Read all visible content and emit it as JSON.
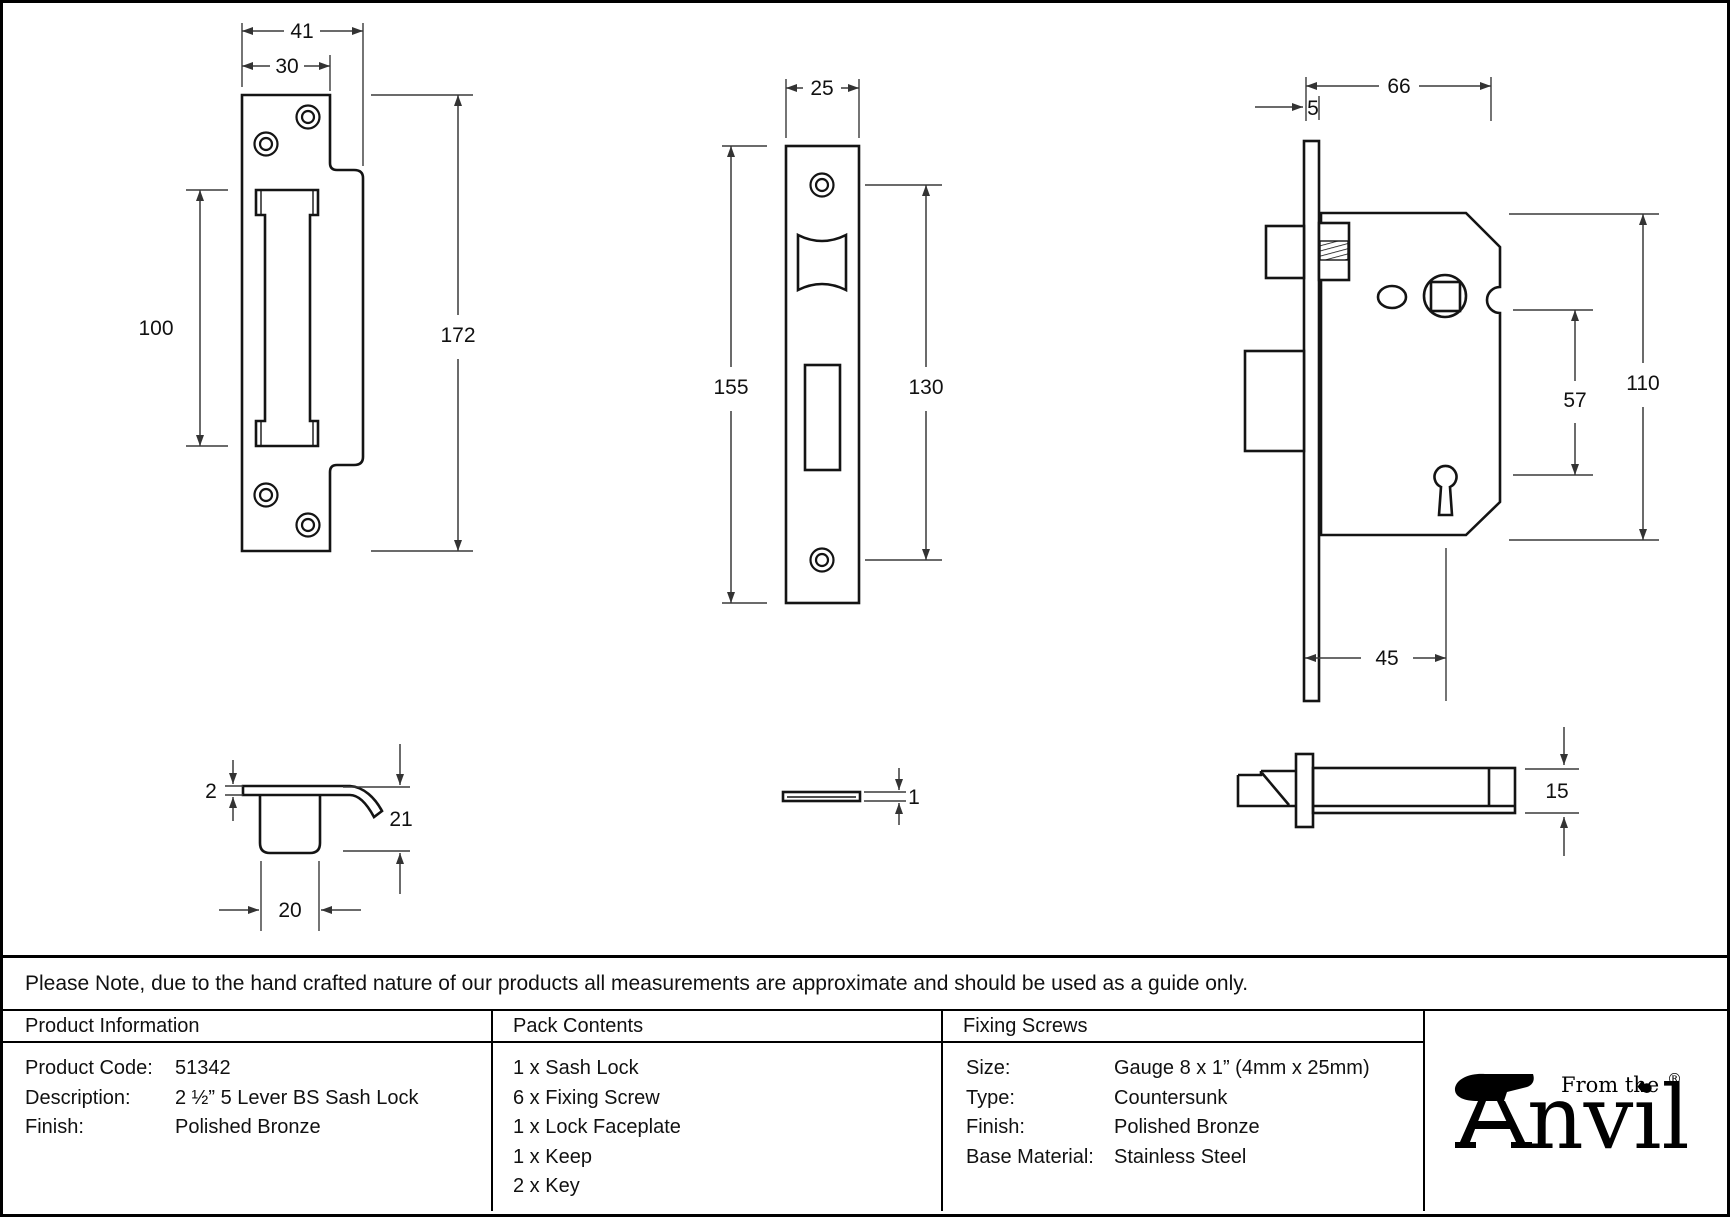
{
  "note": "Please Note, due to the hand crafted nature of our products all measurements are approximate and should be used as a guide only.",
  "drawings": {
    "keep_front": {
      "overall_width": "41",
      "plate_width": "30",
      "opening_height": "100",
      "total_height": "172"
    },
    "faceplate_front": {
      "width": "25",
      "total_height": "155",
      "screw_centres": "130"
    },
    "lock_side": {
      "case_depth": "66",
      "faceplate_thickness": "5",
      "case_height": "110",
      "spindle_to_keyhole": "57",
      "backset": "45"
    },
    "keep_profile": {
      "plate_thickness": "2",
      "depth": "21",
      "box_width": "20"
    },
    "faceplate_profile": {
      "thickness": "1"
    },
    "lock_profile": {
      "case_thickness": "15"
    }
  },
  "table": {
    "product_information": {
      "header": "Product Information",
      "rows": [
        {
          "label": "Product Code:",
          "value": "51342"
        },
        {
          "label": "Description:",
          "value": "2 ½” 5 Lever BS Sash Lock"
        },
        {
          "label": "Finish:",
          "value": "Polished Bronze"
        }
      ]
    },
    "pack_contents": {
      "header": "Pack Contents",
      "items": [
        "1 x Sash Lock",
        "6 x Fixing Screw",
        "1 x Lock Faceplate",
        "1 x Keep",
        "2 x Key"
      ]
    },
    "fixing_screws": {
      "header": "Fixing Screws",
      "rows": [
        {
          "label": "Size:",
          "value": "Gauge 8 x 1” (4mm x 25mm)"
        },
        {
          "label": "Type:",
          "value": "Countersunk"
        },
        {
          "label": "Finish:",
          "value": "Polished Bronze"
        },
        {
          "label": "Base Material:",
          "value": "Stainless Steel"
        }
      ]
    }
  },
  "logo": {
    "tagline": "From the",
    "brand_suffix": "nvil",
    "diamond": "♦",
    "registered": "®"
  }
}
